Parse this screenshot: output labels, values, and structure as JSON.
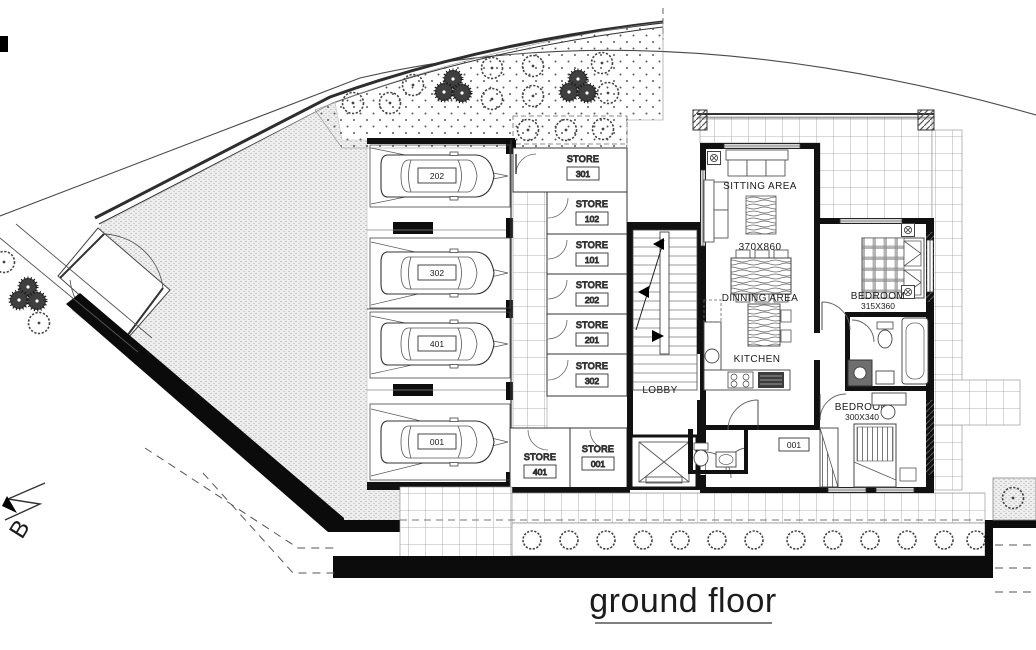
{
  "title": {
    "text": "ground floor"
  },
  "section_marker": {
    "label": "B"
  },
  "garage": {
    "bays": [
      {
        "number": "202"
      },
      {
        "number": "302"
      },
      {
        "number": "401"
      },
      {
        "number": "001"
      }
    ]
  },
  "stores": {
    "label": "STORE",
    "units": [
      {
        "number": "301"
      },
      {
        "number": "102"
      },
      {
        "number": "101"
      },
      {
        "number": "202"
      },
      {
        "number": "201"
      },
      {
        "number": "302"
      },
      {
        "number": "401"
      },
      {
        "number": "001"
      }
    ]
  },
  "lobby": {
    "label": "LOBBY"
  },
  "apartment": {
    "sitting_area": {
      "label": "SITTING AREA",
      "dimensions": "370X860"
    },
    "dining_area": {
      "label": "DINNING AREA"
    },
    "kitchen": {
      "label": "KITCHEN"
    },
    "bedroom_1": {
      "label": "BEDROOM",
      "dimensions": "315X360"
    },
    "bedroom_2": {
      "label": "BEDROOM",
      "dimensions": "300X340"
    },
    "unit_number": "001"
  },
  "colors": {
    "line": "#2b2b2b",
    "wall": "#0d0d0d",
    "tile_line": "#9a9a9a",
    "garden_dot": "#5a5a5a",
    "background": "#ffffff"
  }
}
